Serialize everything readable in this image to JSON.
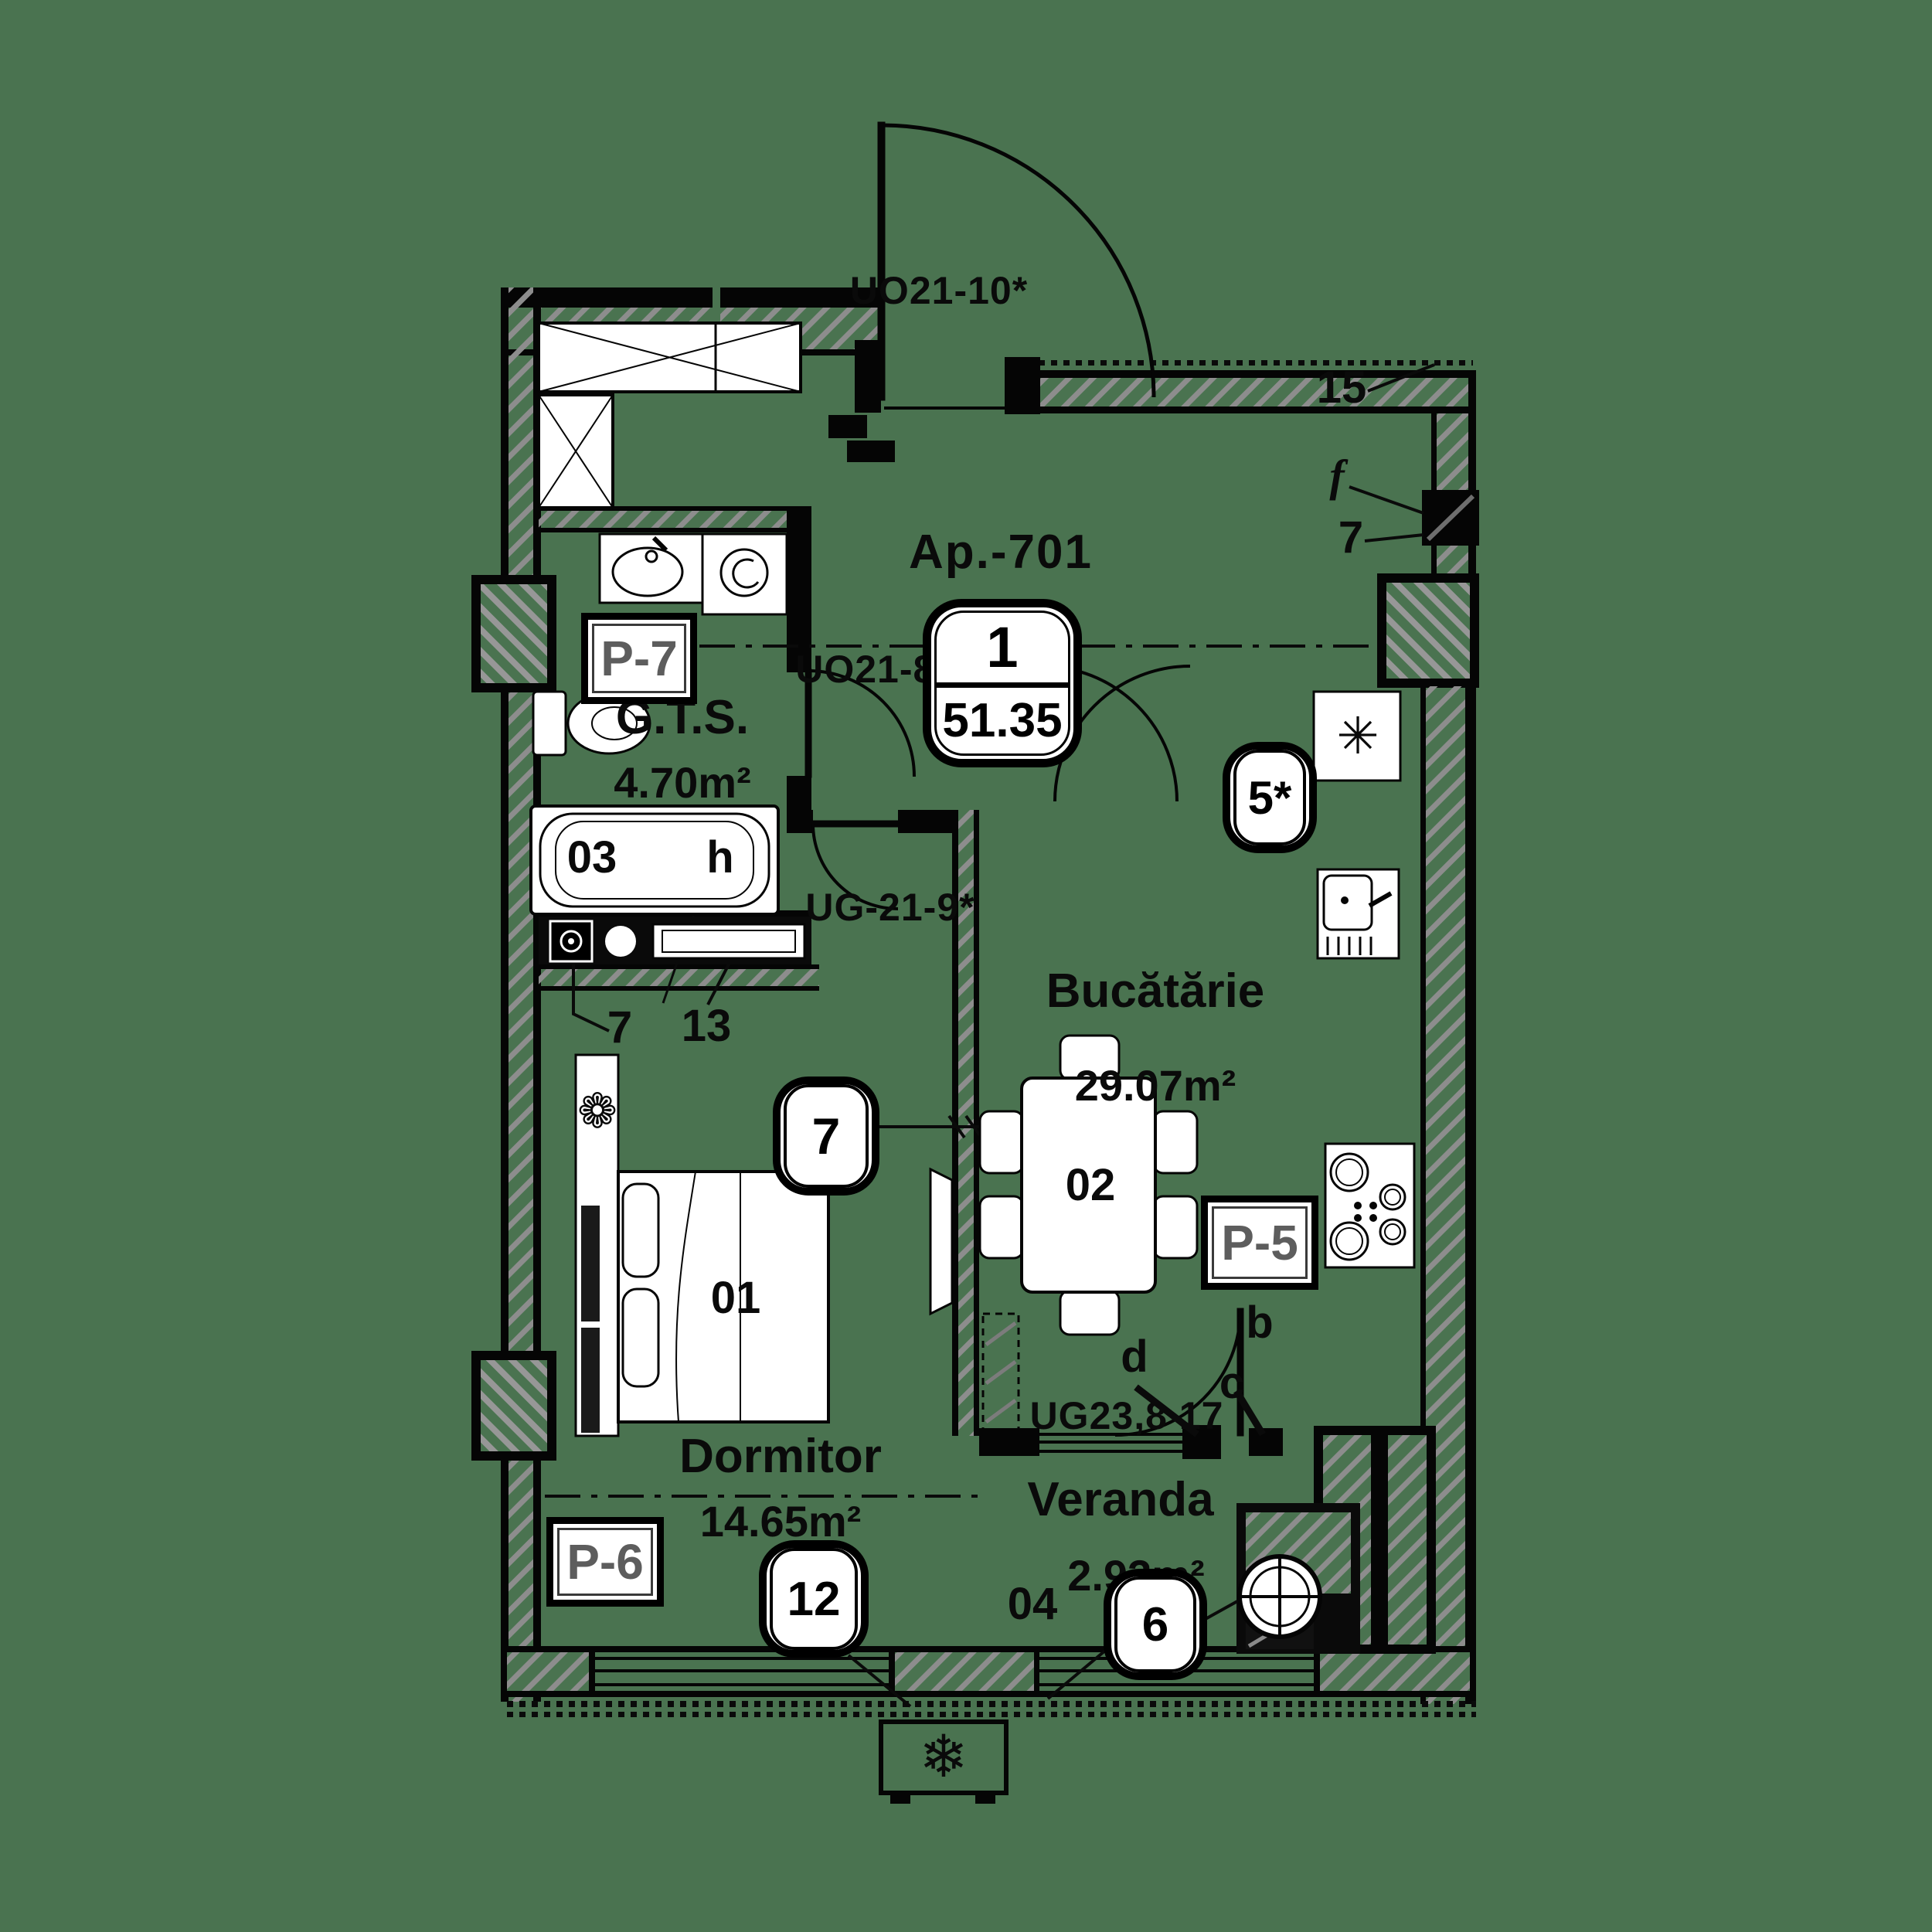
{
  "apartment": {
    "title": "Ap.-701",
    "unit_count": "1",
    "total_area": "51.35"
  },
  "doors": {
    "entrance": "UO21-10*",
    "bathroom": "UO21-8*",
    "bedroom": "UG-21-9*",
    "veranda": "UG23,8 17"
  },
  "rooms": {
    "bathroom": {
      "name": "G.T.S.",
      "area": "4.70m²",
      "panel": "P-7",
      "tub_id": "03",
      "tub_mark": "h",
      "drain_callout": "7",
      "radiator_callout": "13"
    },
    "kitchen": {
      "name": "Bucătărie",
      "area": "29.07m²",
      "panel": "P-5",
      "table_id": "02",
      "window_marker": "5*",
      "parapet_callout": "15",
      "window_callout_f": "f",
      "window_callout_7": "7"
    },
    "bedroom": {
      "name": "Dormitor",
      "area": "14.65m²",
      "panel": "P-6",
      "bed_id": "01",
      "door_marker": "7",
      "window_marker": "12"
    },
    "veranda": {
      "name": "Veranda",
      "area": "2.93m²",
      "floor_id": "04",
      "window_marker": "6",
      "hinge_b": "b",
      "hinge_c": "c",
      "hinge_d": "d"
    }
  },
  "icons": {
    "fridge": "✳",
    "ac": "❄",
    "plant": "❁"
  }
}
